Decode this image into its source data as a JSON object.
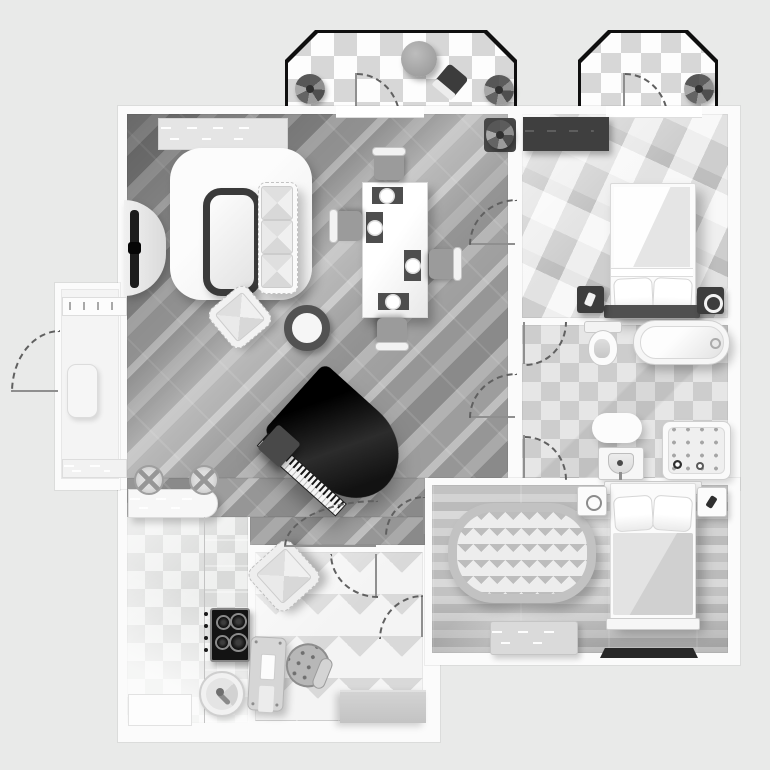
{
  "canvas": {
    "width": 770,
    "height": 770,
    "background": "#e9eae9"
  },
  "palette": {
    "wall": "#fbfbfb",
    "wall_outline": "#dcdcdc",
    "balcony_border": "#0f0f0f",
    "plank_dark": "#8a8a8a",
    "plank_light": "#bfbfbf",
    "checker_white": "#fdfdfd",
    "checker_gray": "#d7d7d7",
    "bath_checker_a": "#e6e6e6",
    "bath_checker_b": "#cdcdcd",
    "piano_black": "#161616",
    "furniture_dark": "#3d3d3d",
    "furniture_white": "#fafafa"
  },
  "floorplan": {
    "type": "apartment-top-view",
    "balconies": [
      {
        "name": "balcony-left",
        "floor": "checker-tile",
        "items": [
          "round-table",
          "balcony-chair",
          "potted-plant-left",
          "potted-plant-right",
          "door-swing"
        ]
      },
      {
        "name": "balcony-right",
        "floor": "checker-tile",
        "items": [
          "potted-plant",
          "door-swing"
        ]
      }
    ],
    "rooms": [
      {
        "name": "living-room",
        "floor": "diagonal-plank",
        "items": [
          "window-sideboard",
          "tv-console",
          "tv",
          "area-rug",
          "coffee-table",
          "sofa-3-cushions",
          "armchair",
          "round-side-table",
          "potted-plant",
          "dining-table",
          "dining-chairs-x4",
          "place-settings-x4",
          "grand-piano",
          "piano-bench",
          "bar-counter",
          "bar-stools-x2",
          "door-swing-bedroom",
          "door-swing-bathroom",
          "door-swing-study"
        ]
      },
      {
        "name": "entry",
        "floor": "plain",
        "items": [
          "radiator",
          "door-mat",
          "shelf",
          "exterior-door-swing"
        ]
      },
      {
        "name": "bedroom-master",
        "floor": "geometric-parquet",
        "items": [
          "window",
          "dark-rug",
          "double-bed",
          "pillows-x2",
          "headboard",
          "nightstand-phone",
          "nightstand-speaker"
        ]
      },
      {
        "name": "bathroom",
        "floor": "checker-tile",
        "items": [
          "toilet",
          "bathtub",
          "bath-mat",
          "washbasin",
          "shower-cabin",
          "door-swing-top",
          "door-swing-bottom"
        ]
      },
      {
        "name": "kitchen",
        "floor": "checker-tile-faded",
        "items": [
          "counter-strip",
          "cooktop-4-burners",
          "control-knobs",
          "round-sink",
          "lower-counter"
        ]
      },
      {
        "name": "study",
        "floor": "herringbone-parquet",
        "items": [
          "armchair",
          "desk",
          "swivel-stool",
          "side-table",
          "door-swing-top",
          "door-swing-right"
        ]
      },
      {
        "name": "bedroom-second",
        "floor": "horizontal-plank",
        "items": [
          "oval-chevron-rug",
          "double-bed",
          "pillows-x2",
          "blanket",
          "headboard",
          "footboard",
          "nightstand-ring",
          "nightstand-phone",
          "bench",
          "dark-door-mat",
          "door-swing"
        ]
      }
    ],
    "door_swings_total": 11
  }
}
